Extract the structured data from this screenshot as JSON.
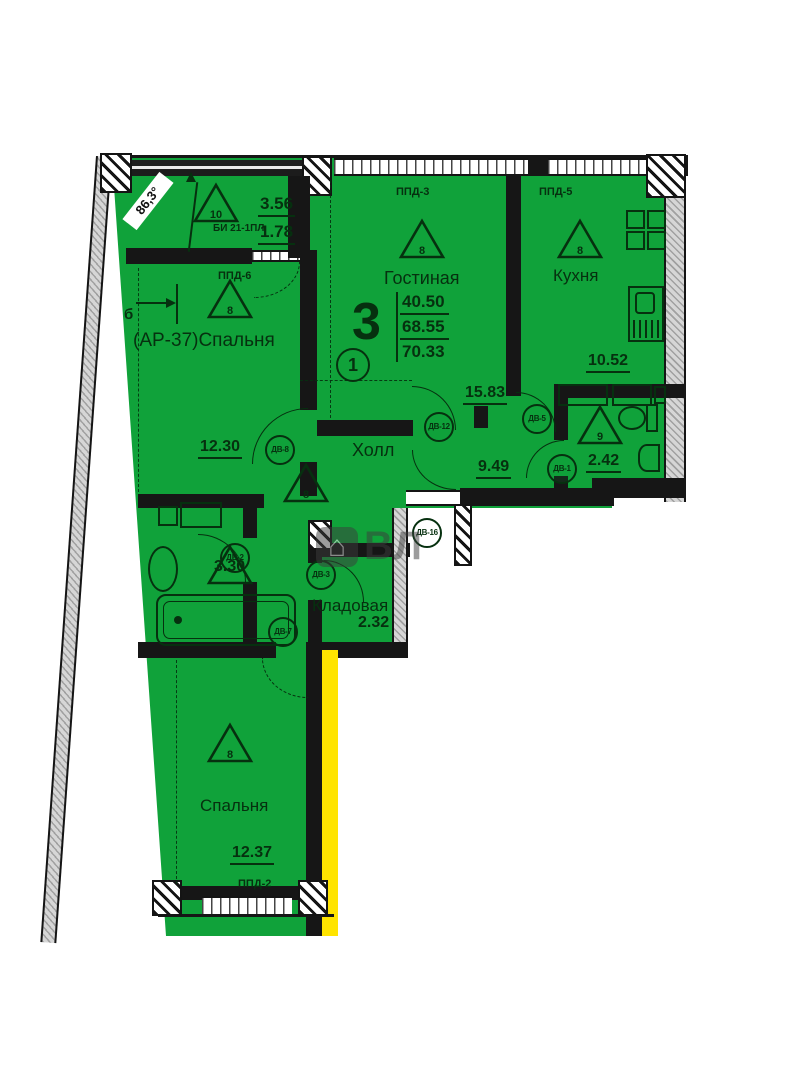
{
  "stamp": {
    "room_count": "3",
    "living_area": "40.50",
    "apartment_area": "68.55",
    "total_area": "70.33",
    "position_number": "1"
  },
  "rooms": {
    "balcony": {
      "floor_type": "10",
      "unit_label": "БИ 21-1ПЛ",
      "area_full": "3.56",
      "area_reduced": "1.78",
      "angle": "86,3°"
    },
    "bedroom_left": {
      "floor_type": "8",
      "name": "(АР-37)Спальня",
      "area": "12.30"
    },
    "living": {
      "floor_type": "8",
      "name": "Гостиная",
      "area": "15.83"
    },
    "kitchen": {
      "floor_type": "8",
      "name": "Кухня",
      "area": "10.52"
    },
    "hall": {
      "floor_type": "8",
      "name": "Холл",
      "area": "9.49"
    },
    "wc": {
      "floor_type": "9",
      "area": "2.42"
    },
    "bathroom": {
      "area": "3.30"
    },
    "storage": {
      "name": "Кладовая",
      "area": "2.32"
    },
    "bedroom_bottom": {
      "floor_type": "8",
      "name": "Спальня",
      "area": "12.37"
    }
  },
  "windows": {
    "ppd2": "ППД-2",
    "ppd3": "ППД-3",
    "ppd5": "ППД-5",
    "ppd6": "ППД-6"
  },
  "doors": {
    "d1": "ДВ-1",
    "d2": "ДВ-2",
    "d3": "ДВ-3",
    "d5": "ДВ-5",
    "d7": "ДВ-7",
    "d8": "ДВ-8",
    "d12": "ДВ-12",
    "d16": "ДВ-16"
  },
  "markers": {
    "section": "б",
    "watermark": "ВЛ"
  },
  "colors": {
    "room_fill": "#10a23a",
    "line_dark": "#06300f",
    "wall_black": "#161616",
    "exterior_gray": "#d6d6d6",
    "highlight_yellow": "#ffe400"
  }
}
